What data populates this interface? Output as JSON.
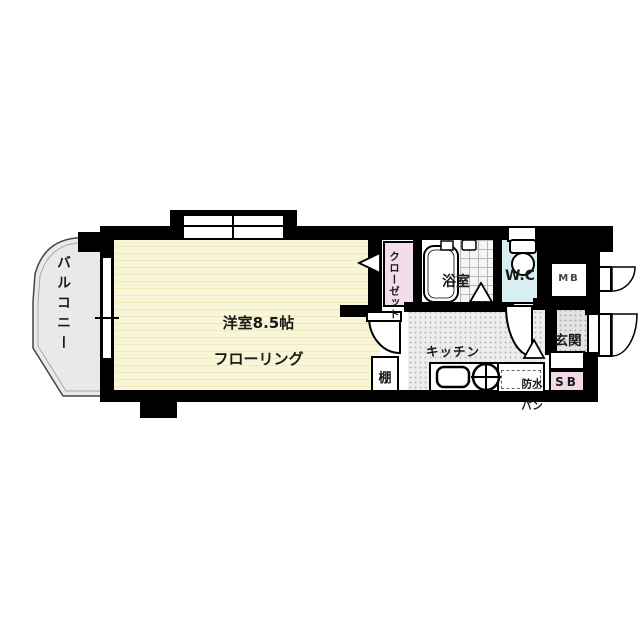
{
  "floorplan": {
    "wall_color": "#000000",
    "rooms": {
      "balcony": {
        "label": "バルコニー",
        "floor_color": "#e9e9e7"
      },
      "western_room": {
        "label_line1": "洋室8.5帖",
        "label_line2": "フローリング",
        "floor_color": "#f9f6d8"
      },
      "closet": {
        "label": "クローゼット",
        "color": "#f3dcec"
      },
      "bathroom": {
        "label": "浴室",
        "color": "#ffffff"
      },
      "toilet": {
        "label": "W.C",
        "color": "#d8eff1"
      },
      "meter_box": {
        "label": "MB"
      },
      "entrance": {
        "label": "玄関",
        "floor_color": "#e3e3e1"
      },
      "kitchen": {
        "label": "キッチン",
        "floor_color": "#ededeb"
      },
      "shelf": {
        "label": "棚"
      },
      "waterproof_pan": {
        "label_line1": "防水",
        "label_line2": "パン"
      },
      "shoe_box": {
        "label": "SB",
        "color": "#f3d9e8"
      }
    }
  }
}
